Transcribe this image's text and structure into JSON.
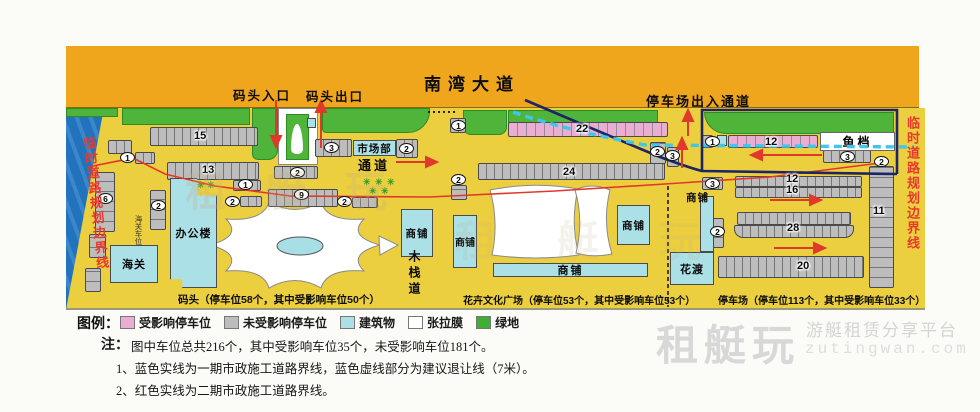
{
  "road": {
    "title": "南湾大道"
  },
  "annotations": {
    "dock_entrance": "码头入口",
    "dock_exit": "码头出口",
    "parking_channel": "停车场出入通道",
    "passage": "通道",
    "boardwalk": "木栈道",
    "left_boundary": "临时道路规划边界线",
    "right_boundary": "临时道路规划边界线",
    "customs_parking": "海关车位"
  },
  "buildings": {
    "market_dept": "市场部",
    "office": "办公楼",
    "customs": "海关",
    "shop": "商铺",
    "flower_ferry": "花渡",
    "fish_stall": "鱼档"
  },
  "captions": {
    "dock": "码头（停车位58个，其中受影响车位50个）",
    "plaza": "花卉文化广场（停车位53个，其中受影响车位53个）",
    "parking_lot": "停车场（停车位113个，其中受影响车位33个）"
  },
  "row_numbers": {
    "n15": "15",
    "n13": "13",
    "n22": "22",
    "n24": "24",
    "n12a": "12",
    "n12b": "12",
    "n16": "16",
    "n28": "28",
    "n20": "20",
    "n11": "11"
  },
  "badges": {
    "n1": "1",
    "n2": "2",
    "n3": "3",
    "n6": "6",
    "n9": "9"
  },
  "glyphs": {
    "plant": "✳"
  },
  "legend": {
    "title": "图例：",
    "items": [
      {
        "label": "受影响停车位",
        "color": "#e9aed2"
      },
      {
        "label": "未受影响停车位",
        "color": "#bdbdbd"
      },
      {
        "label": "建筑物",
        "color": "#abe0e6"
      },
      {
        "label": "张拉膜",
        "color": "#ffffff"
      },
      {
        "label": "绿地",
        "color": "#3fae35"
      }
    ]
  },
  "notes": {
    "prefix": "注：",
    "summary": "图中车位总共216个，其中受影响车位35个，未受影响车位181个。",
    "line1": "1、蓝色实线为一期市政施工道路界线，蓝色虚线部分为建议退让线（7米）。",
    "line2": "2、红色实线为二期市政施工道路界线。"
  },
  "watermark": {
    "brand": "租艇玩",
    "tagline": "游艇租赁分享平台",
    "domain": "zutingwan.com"
  },
  "colors": {
    "road": "#efa51c",
    "ground": "#eccf3e",
    "green": "#4fb53a",
    "water": "#2273bd",
    "building": "#abe0e6",
    "affected": "#e9aed2",
    "unaffected": "#bdbdbd",
    "phase2_red_line": "#e0392c",
    "phase1_blue_line": "#1c2566",
    "setback_dashed": "#3fc6ee",
    "boundary_text": "#e8392f"
  }
}
